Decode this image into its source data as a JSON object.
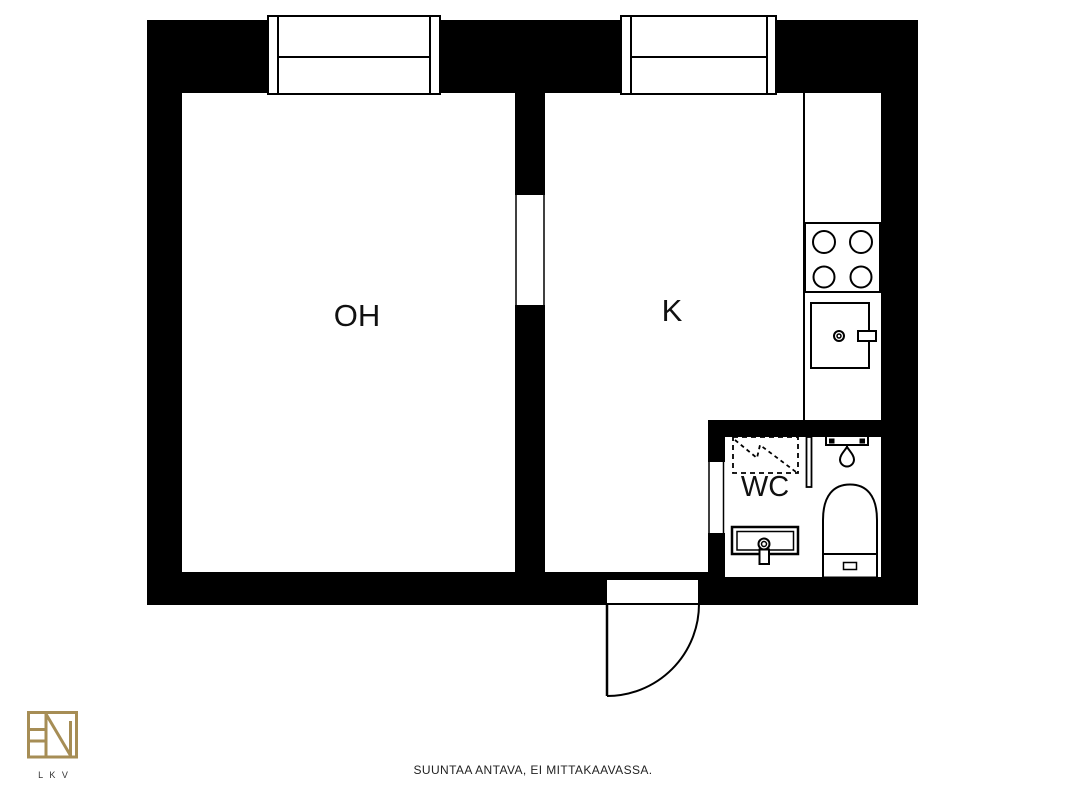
{
  "floor_plan": {
    "rooms": [
      {
        "id": "oh",
        "label": "OH"
      },
      {
        "id": "k",
        "label": "K"
      },
      {
        "id": "wc",
        "label": "WC"
      }
    ],
    "fixtures": [
      "window-icon",
      "window-icon",
      "entrance-door-swing-icon",
      "counter-line",
      "stove-icon",
      "kitchen-sink-icon",
      "reservation-dashed-icon",
      "shower-icon",
      "washbasin-icon",
      "toilet-icon"
    ],
    "colors": {
      "wall": "#000000",
      "floor": "#ffffff",
      "line": "#000000",
      "logo_gold": "#a68d55"
    }
  },
  "footer": {
    "disclaimer": "SUUNTAA ANTAVA, EI MITTAKAAVASSA."
  },
  "logo": {
    "text": "L K V"
  }
}
